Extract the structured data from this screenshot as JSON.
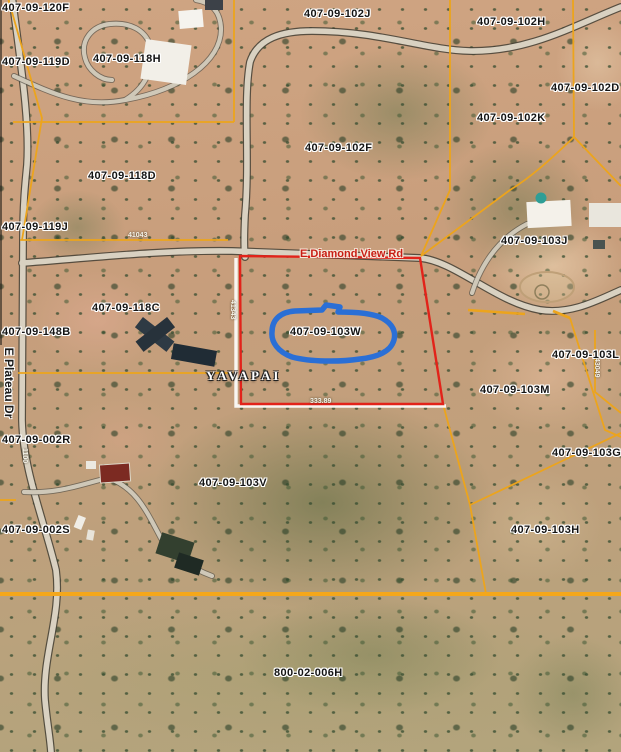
{
  "map": {
    "parcel_labels": [
      "407-09-120F",
      "407-09-119D",
      "407-09-118H",
      "407-09-102J",
      "407-09-102H",
      "407-09-102D",
      "407-09-102F",
      "407-09-102K",
      "407-09-118D",
      "407-09-119J",
      "407-09-103J",
      "407-09-118C",
      "407-09-148B",
      "407-09-103W",
      "407-09-103L",
      "407-09-103M",
      "407-09-002R",
      "407-09-103V",
      "407-09-103G",
      "407-09-002S",
      "407-09-103H",
      "800-02-006H"
    ],
    "road_labels": {
      "diamond_view": "E Diamond View Rd",
      "plateau": "E Plateau Dr"
    },
    "jurisdiction_label": "YAVAPAI",
    "highlighted_parcel": "407-09-103W",
    "dimension_labels": [
      "41043",
      "41343",
      "333.89",
      "43049",
      "1100"
    ],
    "colors": {
      "parcel_line": "#ECA41C",
      "section_line": "#F4A71B",
      "selected_parcel_outline": "#E2231A",
      "highlight_ellipse": "#2A6FD6",
      "parcel_label_text": "#141414",
      "road_label_text": "#C81E14"
    }
  }
}
